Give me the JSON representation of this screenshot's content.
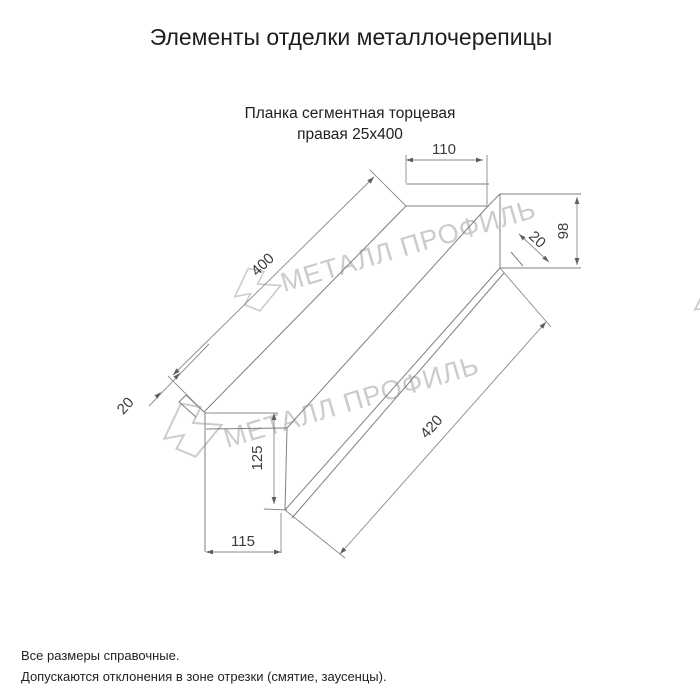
{
  "header": {
    "title": "Элементы отделки металлочерепицы"
  },
  "drawing": {
    "subtitle_line1": "Планка сегментная торцевая",
    "subtitle_line2": "правая 25х400",
    "dimensions": {
      "top_width": "110",
      "end_height": "98",
      "end_hem": "20",
      "length_top": "400",
      "near_hem": "20",
      "length_bottom": "420",
      "near_height": "125",
      "bottom_width": "115"
    },
    "watermark_text": "МЕТАЛЛ ПРОФИЛЬ",
    "line_color": "#7f7f7f",
    "watermark_color": "#cbcbcb"
  },
  "footer": {
    "line1": "Все размеры справочные.",
    "line2": "Допускаются отклонения в зоне отрезки (смятие, заусенцы)."
  }
}
